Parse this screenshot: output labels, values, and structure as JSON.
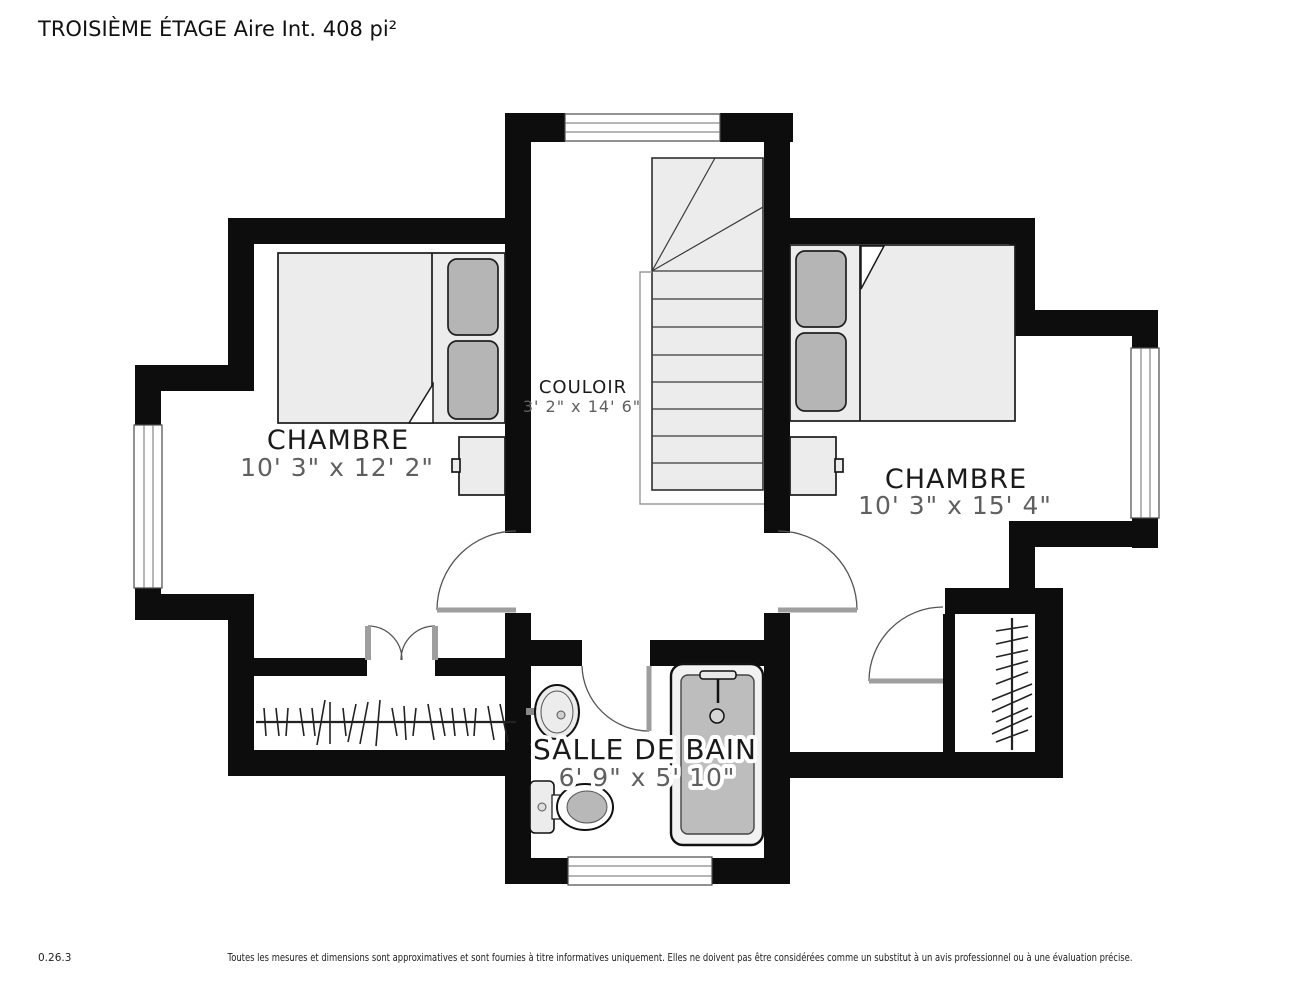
{
  "title": "TROISIÈME ÉTAGE Aire Int. 408 pi²",
  "rooms": {
    "bedroom_left": {
      "name": "CHAMBRE",
      "dimensions": "10' 3\" x 12' 2\""
    },
    "bedroom_right": {
      "name": "CHAMBRE",
      "dimensions": "10' 3\" x 15' 4\""
    },
    "corridor": {
      "name": "COULOIR",
      "dimensions": "3' 2\" x 14' 6\""
    },
    "bathroom": {
      "name": "SALLE DE BAIN",
      "dimensions": "6' 9\" x 5' 10\""
    }
  },
  "footer": {
    "version": "0.26.3",
    "disclaimer": "Toutes les mesures et dimensions sont approximatives et sont fournies à titre informatives uniquement. Elles ne doivent pas être considérées comme un substitut à un avis professionnel ou à une évaluation précise."
  },
  "colors": {
    "wall": "#0d0d0d",
    "furniture_light": "#ececec",
    "furniture_mid": "#b5b5b5",
    "label": "#1a1a1a",
    "dimension": "#5f5f5f"
  }
}
